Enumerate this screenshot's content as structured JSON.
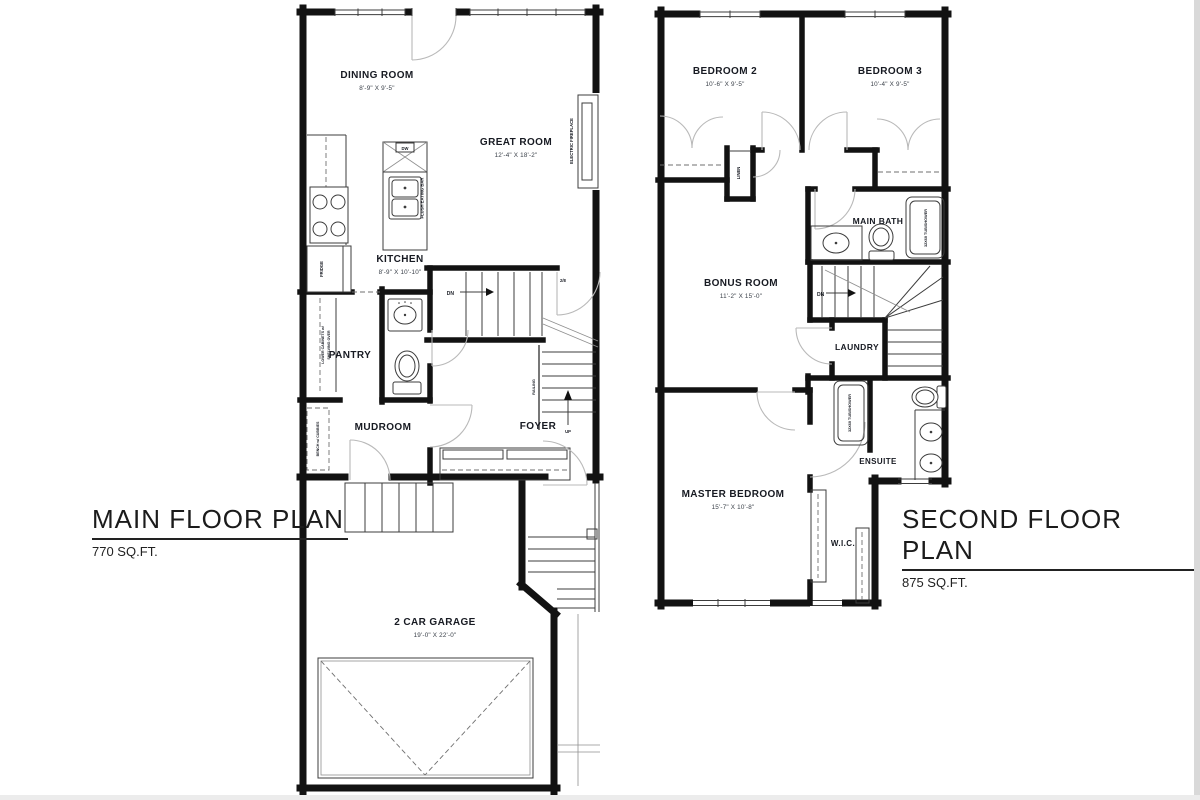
{
  "main_floor": {
    "title": "MAIN FLOOR PLAN",
    "area": "770 SQ.FT.",
    "rooms": {
      "dining": {
        "name": "DINING ROOM",
        "dims": "8'-9\" X 9'-5\""
      },
      "great": {
        "name": "GREAT ROOM",
        "dims": "12'-4\" X 18'-2\""
      },
      "kitchen": {
        "name": "KITCHEN",
        "dims": "8'-9\" X 10'-10\""
      },
      "pantry": {
        "name": "PANTRY"
      },
      "mudroom": {
        "name": "MUDROOM"
      },
      "foyer": {
        "name": "FOYER"
      },
      "garage": {
        "name": "2 CAR GARAGE",
        "dims": "19'-0\" X 22'-0\""
      }
    },
    "annotations": {
      "fridge": "FRIDGE",
      "dishwasher": "DW",
      "flush_eating_bar": "FLUSH EATING BAR",
      "electric_fireplace": "ELECTRIC FIREPLACE",
      "lower_cabinets_line1": "LOWER CABINETS w/",
      "lower_cabinets_line2": "SHELVING OVER",
      "bench": "BENCH w/ CUBBIES",
      "railing": "RAILING",
      "stairs_down": "DN",
      "stairs_up": "UP",
      "door_size": "2/8"
    }
  },
  "second_floor": {
    "title": "SECOND FLOOR PLAN",
    "area": "875 SQ.FT.",
    "rooms": {
      "bedroom2": {
        "name": "BEDROOM 2",
        "dims": "10'-6\" X 9'-5\""
      },
      "bedroom3": {
        "name": "BEDROOM 3",
        "dims": "10'-4\" X 9'-5\""
      },
      "main_bath": {
        "name": "MAIN BATH"
      },
      "bonus": {
        "name": "BONUS ROOM",
        "dims": "11'-2\" X 15'-0\""
      },
      "laundry": {
        "name": "LAUNDRY"
      },
      "ensuite": {
        "name": "ENSUITE"
      },
      "master": {
        "name": "MASTER BEDROOM",
        "dims": "15'-7\" X 10'-8\""
      },
      "wic": {
        "name": "W.I.C."
      }
    },
    "annotations": {
      "linen": "LINEN",
      "main_bath_tub": "32X60 TUB/SHOWER",
      "ensuite_tub": "32X60 TUB/SHOWER",
      "stairs_down": "DN"
    }
  }
}
